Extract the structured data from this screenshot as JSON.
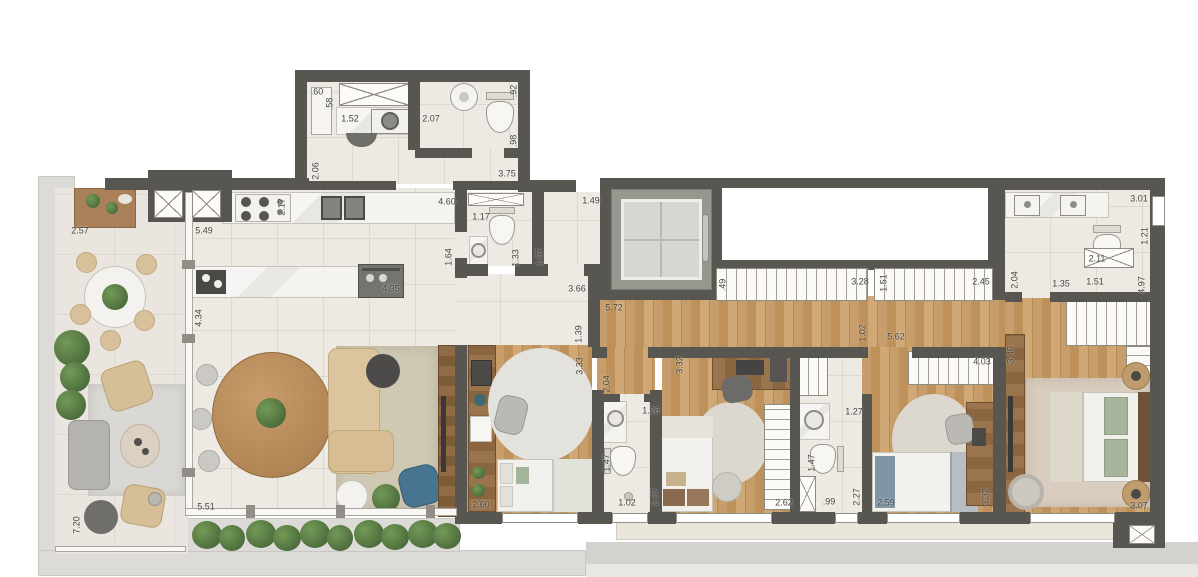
{
  "meta": {
    "kind": "apartment-floor-plan",
    "units": "meters"
  },
  "colors": {
    "wall": "#585650",
    "wood_floor": "#c79e6b",
    "tile_floor": "#edeae3",
    "terrace_floor": "#eae5de",
    "accent_blue": "#47748e",
    "plant_green": "#4e7a46",
    "label_text": "#44433e"
  },
  "dimension_labels": [
    {
      "text": ".60",
      "x": 317,
      "y": 92,
      "vertical": false
    },
    {
      "text": ".58",
      "x": 330,
      "y": 104,
      "vertical": true
    },
    {
      "text": "1.52",
      "x": 350,
      "y": 119,
      "vertical": false
    },
    {
      "text": "2.07",
      "x": 431,
      "y": 119,
      "vertical": false
    },
    {
      "text": ".92",
      "x": 514,
      "y": 91,
      "vertical": true
    },
    {
      "text": ".98",
      "x": 514,
      "y": 141,
      "vertical": true
    },
    {
      "text": "2.06",
      "x": 316,
      "y": 171,
      "vertical": true
    },
    {
      "text": "3.75",
      "x": 507,
      "y": 174,
      "vertical": false
    },
    {
      "text": "4.60",
      "x": 447,
      "y": 202,
      "vertical": false
    },
    {
      "text": "2.57",
      "x": 80,
      "y": 231,
      "vertical": false
    },
    {
      "text": "5.49",
      "x": 204,
      "y": 231,
      "vertical": false
    },
    {
      "text": "2.17",
      "x": 282,
      "y": 207,
      "vertical": true
    },
    {
      "text": "4.35",
      "x": 391,
      "y": 289,
      "vertical": false
    },
    {
      "text": "1.64",
      "x": 449,
      "y": 257,
      "vertical": true
    },
    {
      "text": "4.34",
      "x": 199,
      "y": 318,
      "vertical": true
    },
    {
      "text": "5.51",
      "x": 206,
      "y": 507,
      "vertical": false
    },
    {
      "text": "7.20",
      "x": 77,
      "y": 525,
      "vertical": true
    },
    {
      "text": "1.17",
      "x": 481,
      "y": 217,
      "vertical": false
    },
    {
      "text": "1.33",
      "x": 516,
      "y": 258,
      "vertical": true
    },
    {
      "text": "1.67",
      "x": 540,
      "y": 257,
      "vertical": true
    },
    {
      "text": "1.49",
      "x": 591,
      "y": 201,
      "vertical": false
    },
    {
      "text": "3.66",
      "x": 577,
      "y": 289,
      "vertical": false
    },
    {
      "text": "5.72",
      "x": 614,
      "y": 308,
      "vertical": false
    },
    {
      "text": "1.39",
      "x": 579,
      "y": 334,
      "vertical": true
    },
    {
      "text": ".49",
      "x": 723,
      "y": 285,
      "vertical": true
    },
    {
      "text": "3.28",
      "x": 860,
      "y": 282,
      "vertical": false
    },
    {
      "text": "1.51",
      "x": 884,
      "y": 283,
      "vertical": true
    },
    {
      "text": "2.45",
      "x": 981,
      "y": 282,
      "vertical": false
    },
    {
      "text": "1.02",
      "x": 863,
      "y": 333,
      "vertical": true
    },
    {
      "text": "5.62",
      "x": 896,
      "y": 337,
      "vertical": false
    },
    {
      "text": "3.01",
      "x": 1139,
      "y": 199,
      "vertical": false
    },
    {
      "text": "1.21",
      "x": 1145,
      "y": 236,
      "vertical": true
    },
    {
      "text": "2.11",
      "x": 1097,
      "y": 259,
      "vertical": false
    },
    {
      "text": "2.04",
      "x": 1015,
      "y": 280,
      "vertical": true
    },
    {
      "text": "1.35",
      "x": 1061,
      "y": 284,
      "vertical": false
    },
    {
      "text": "1.51",
      "x": 1095,
      "y": 282,
      "vertical": false
    },
    {
      "text": "4.97",
      "x": 1142,
      "y": 285,
      "vertical": true
    },
    {
      "text": "3.33",
      "x": 580,
      "y": 366,
      "vertical": true
    },
    {
      "text": "2.04",
      "x": 607,
      "y": 384,
      "vertical": true
    },
    {
      "text": "1.28",
      "x": 651,
      "y": 411,
      "vertical": false
    },
    {
      "text": "1.47",
      "x": 607,
      "y": 463,
      "vertical": true
    },
    {
      "text": "1.02",
      "x": 627,
      "y": 503,
      "vertical": false
    },
    {
      "text": "2.27",
      "x": 655,
      "y": 497,
      "vertical": true
    },
    {
      "text": "2.60",
      "x": 481,
      "y": 505,
      "vertical": false
    },
    {
      "text": "3.32",
      "x": 680,
      "y": 365,
      "vertical": true
    },
    {
      "text": "2.62",
      "x": 784,
      "y": 503,
      "vertical": false
    },
    {
      "text": "1.27",
      "x": 854,
      "y": 412,
      "vertical": false
    },
    {
      "text": "1.47",
      "x": 812,
      "y": 463,
      "vertical": true
    },
    {
      "text": ".99",
      "x": 829,
      "y": 502,
      "vertical": false
    },
    {
      "text": "2.27",
      "x": 857,
      "y": 497,
      "vertical": true
    },
    {
      "text": "4.03",
      "x": 982,
      "y": 362,
      "vertical": false
    },
    {
      "text": "2.59",
      "x": 886,
      "y": 503,
      "vertical": false
    },
    {
      "text": "3.32",
      "x": 986,
      "y": 497,
      "vertical": true
    },
    {
      "text": "3.46",
      "x": 1011,
      "y": 355,
      "vertical": true
    },
    {
      "text": "3.07",
      "x": 1139,
      "y": 506,
      "vertical": false
    }
  ]
}
